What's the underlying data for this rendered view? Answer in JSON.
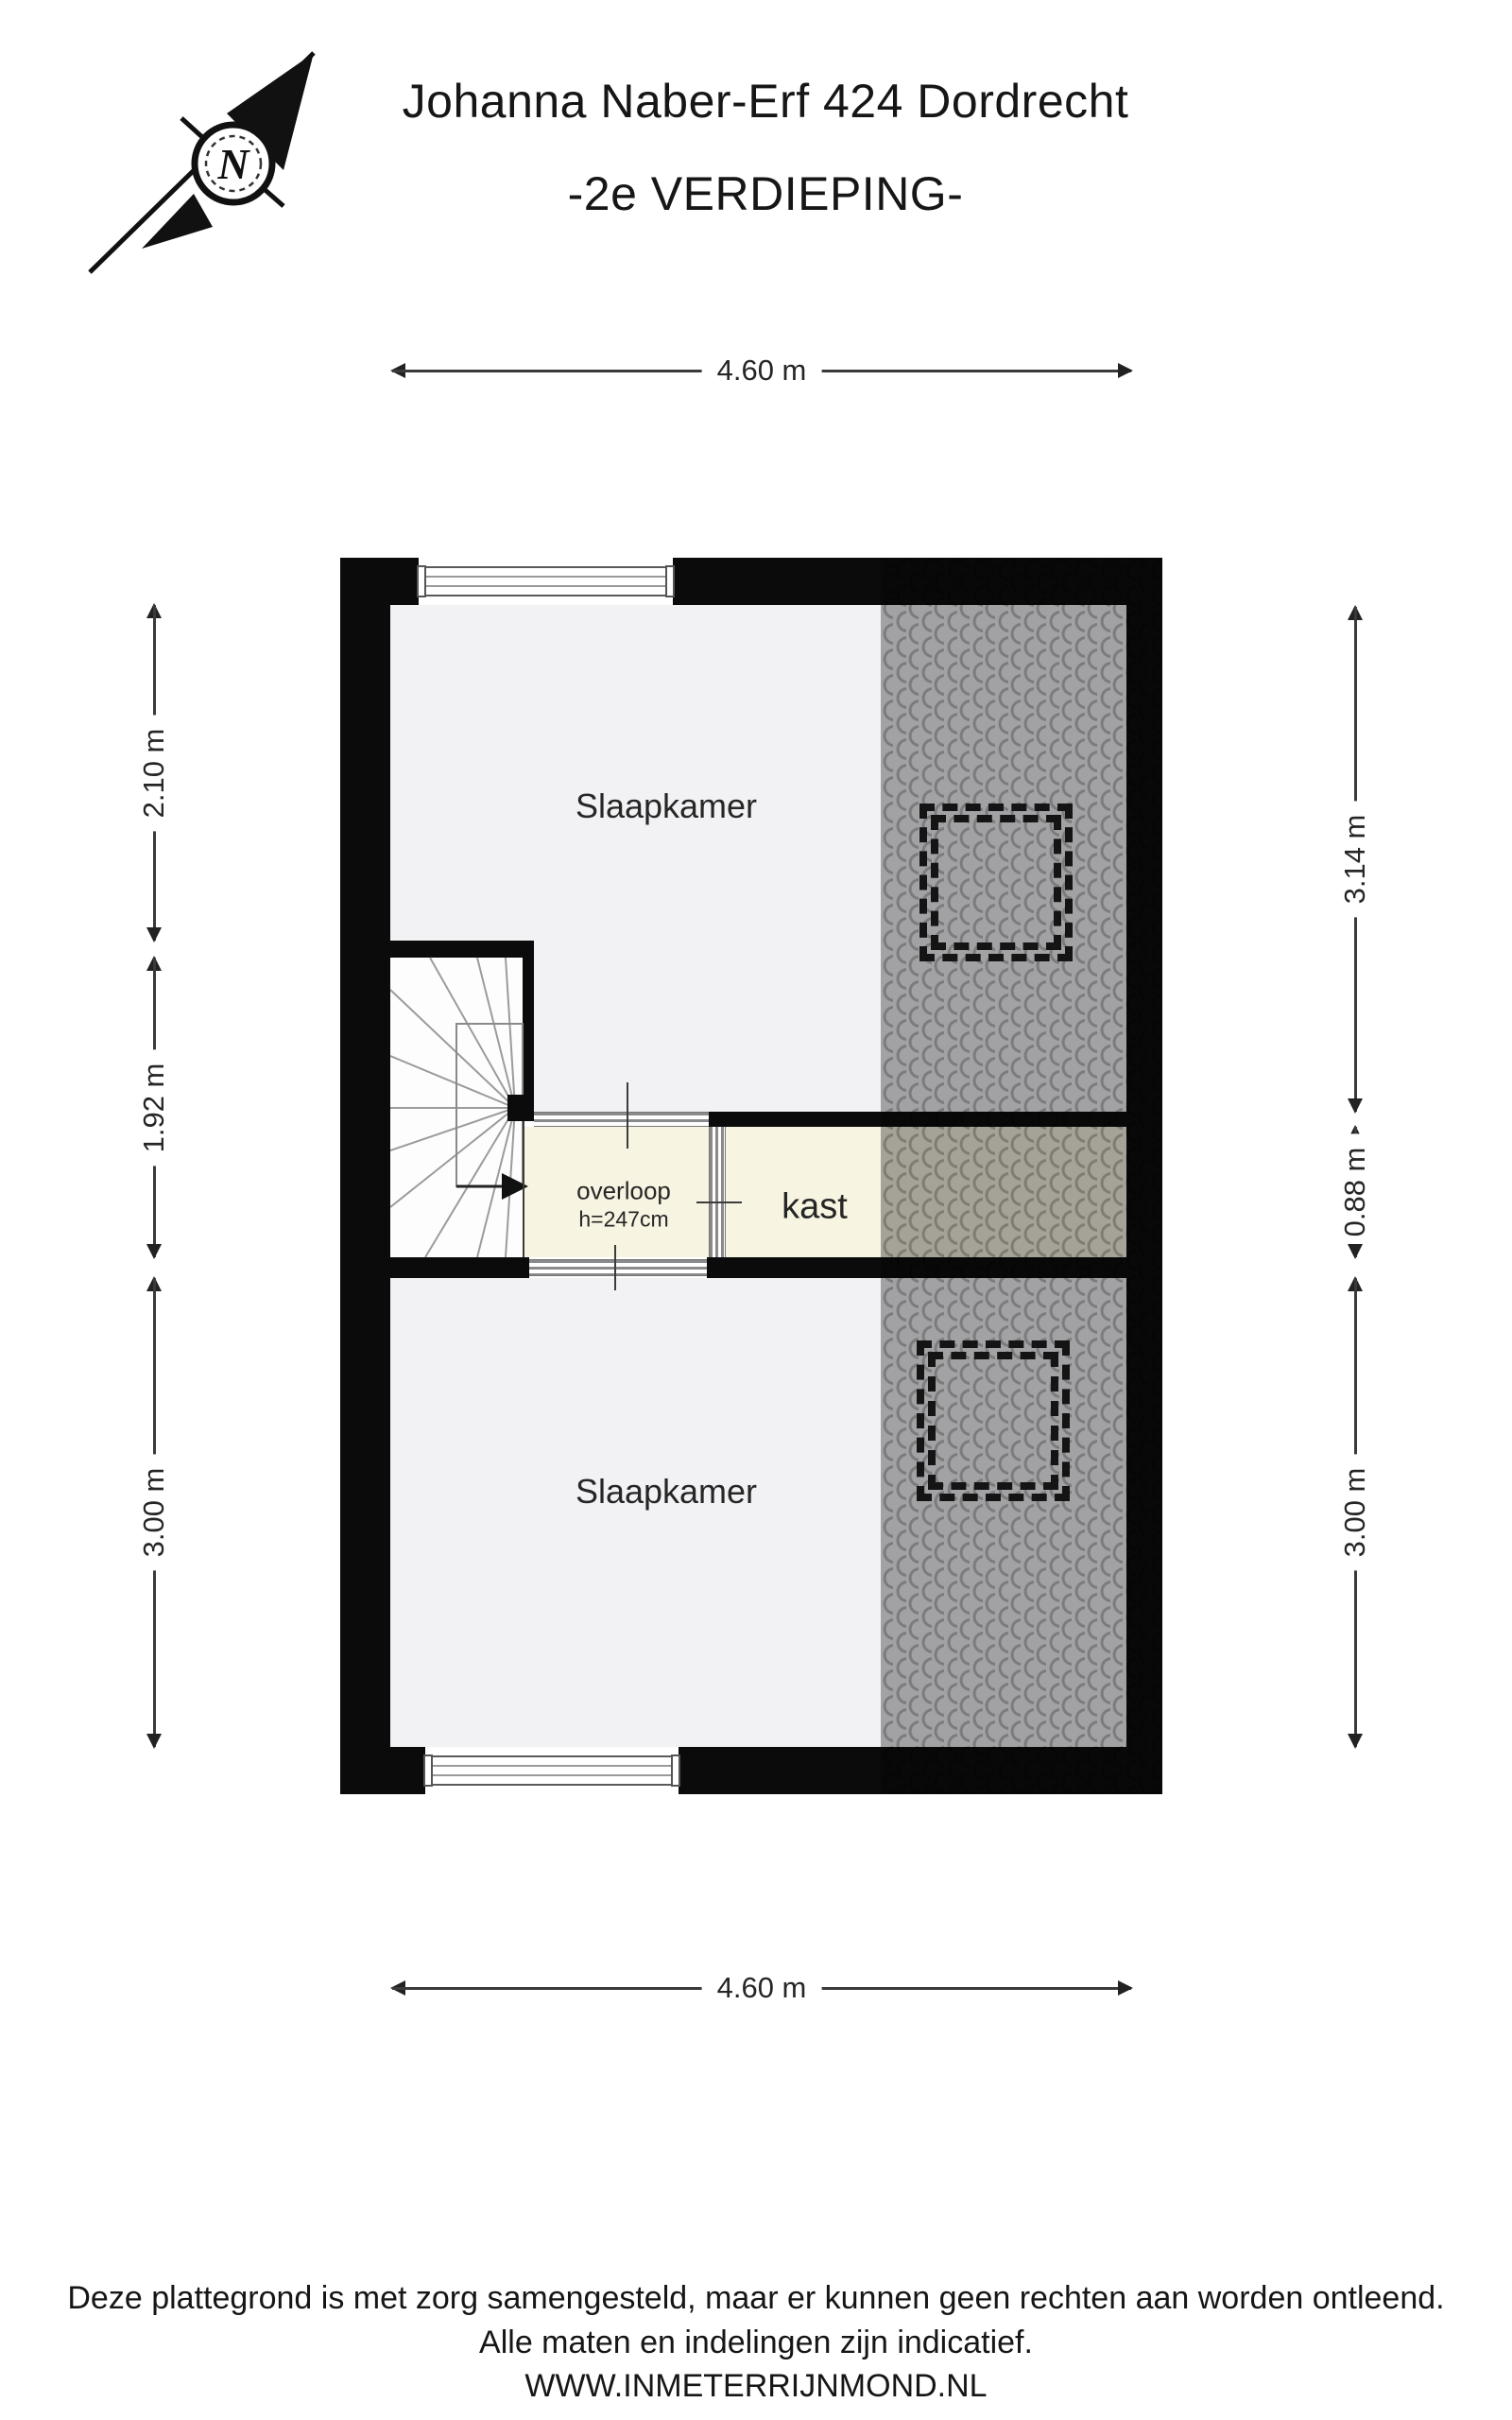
{
  "title": {
    "line1": "Johanna Naber-Erf 424 Dordrecht",
    "line2": "-2e VERDIEPING-"
  },
  "compass": {
    "north_label": "N"
  },
  "rooms": {
    "bedroom_top": "Slaapkamer",
    "bedroom_bottom": "Slaapkamer",
    "landing": "overloop",
    "landing_height": "h=247cm",
    "closet": "kast"
  },
  "dimensions": {
    "top": "4.60 m",
    "bottom": "4.60 m",
    "left": [
      "2.10 m",
      "1.92 m",
      "3.00 m"
    ],
    "right": [
      "3.14 m",
      "0.88 m",
      "3.00 m"
    ]
  },
  "footer": [
    "Deze plattegrond is met zorg samengesteld, maar er kunnen geen rechten aan worden ontleend.",
    "Alle maten en indelingen zijn indicatief.",
    "WWW.INMETERRIJNMOND.NL"
  ],
  "colors": {
    "wall": "#0b0b0b",
    "floor": "#f2f2f5",
    "floor_cream": "#f7f4e1",
    "roof_base": "#ababab",
    "roof_arc": "#828282",
    "dashed_outline": "#141414"
  }
}
